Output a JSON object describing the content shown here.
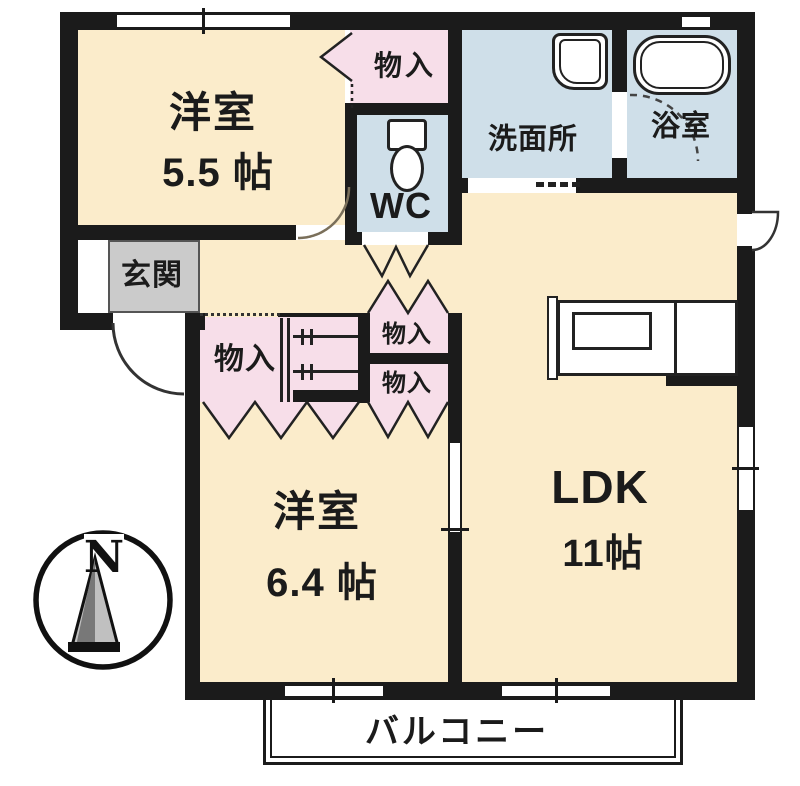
{
  "colors": {
    "wall": "#1b1b1b",
    "room_cream": "#fbeccb",
    "closet_pink": "#f7dee9",
    "wet_blue": "#cfdfe9",
    "genkan_gray": "#cbcbcb"
  },
  "rooms": {
    "bedroom_top": {
      "label": "洋室",
      "size": "5.5 帖"
    },
    "bedroom_bottom": {
      "label": "洋室",
      "size": "6.4 帖"
    },
    "ldk": {
      "label": "LDK",
      "size": "11帖"
    },
    "washroom": {
      "label": "洗面所"
    },
    "bathroom": {
      "label": "浴室"
    },
    "wc": {
      "label": "WC"
    },
    "entrance": {
      "label": "玄関"
    },
    "balcony": {
      "label": "バルコニー"
    },
    "closet_upper": {
      "label": "物入"
    },
    "closet_middle": {
      "label": "物入"
    },
    "closet_right_top": {
      "label": "物入"
    },
    "closet_right_bottom": {
      "label": "物入"
    }
  },
  "compass": {
    "north_label": "N"
  }
}
